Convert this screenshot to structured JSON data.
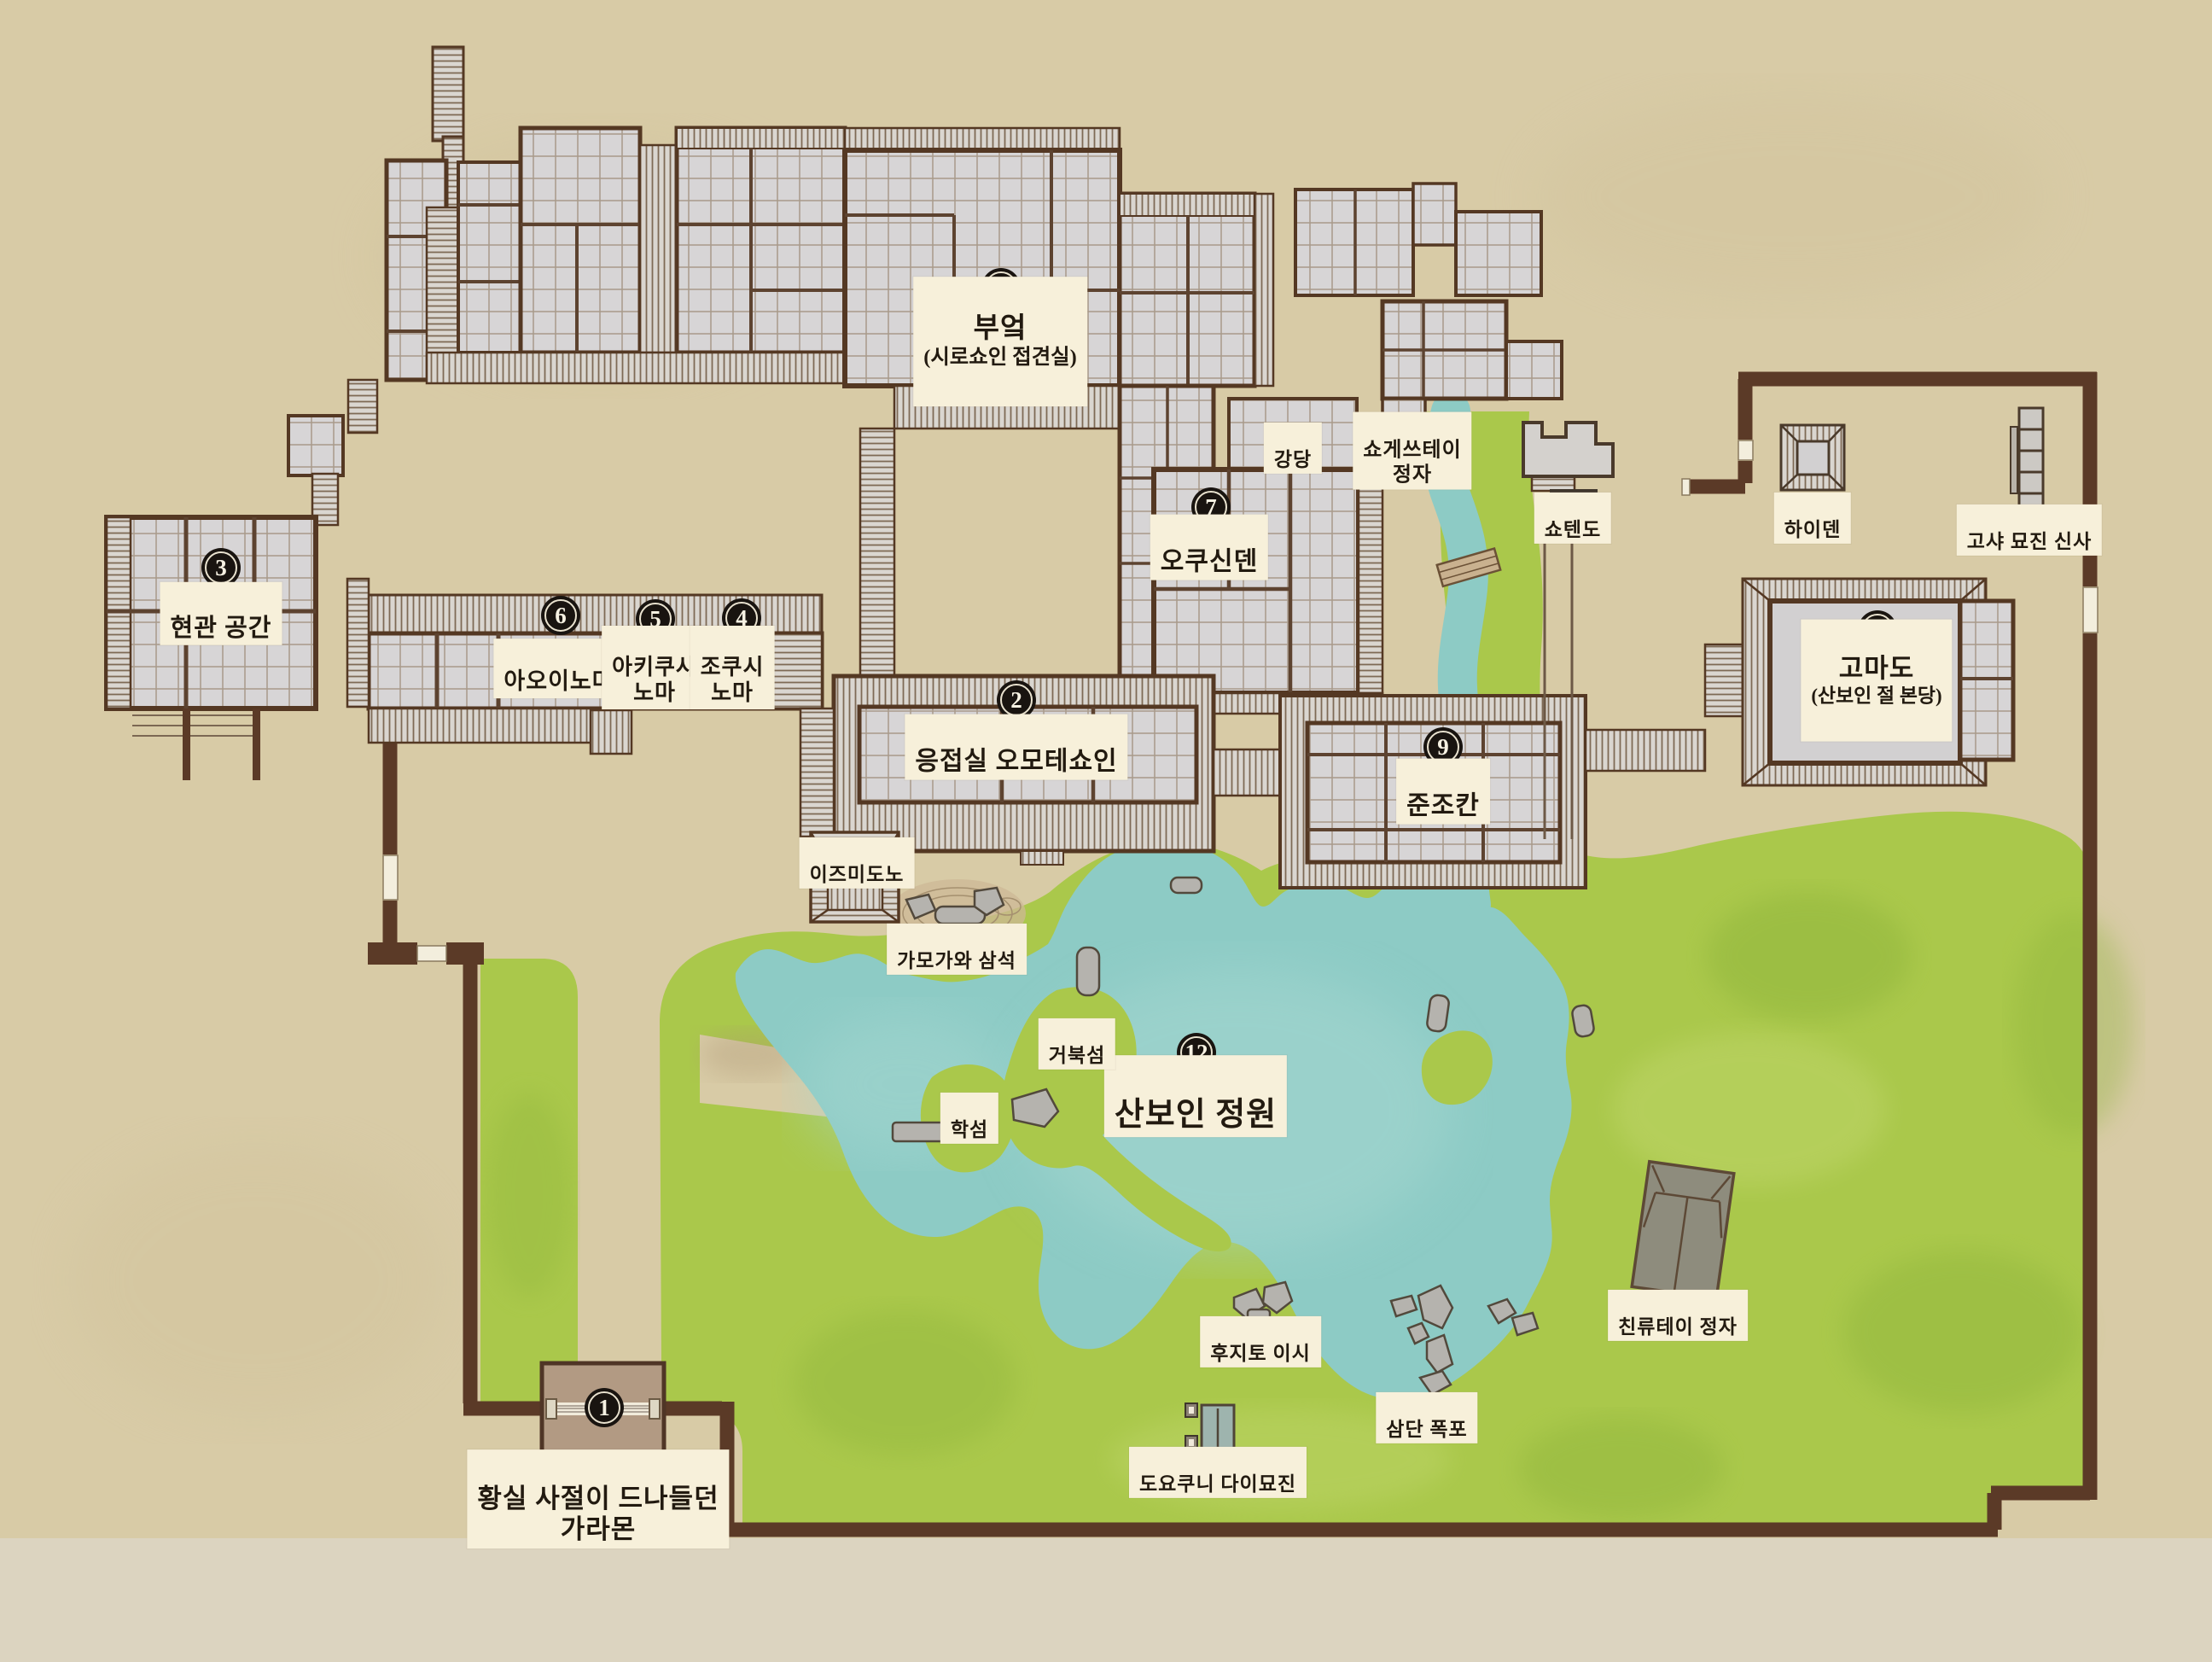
{
  "map": {
    "title_note": "산보인(三宝院) 경내 안내도",
    "colors": {
      "paper": "#d8cba6",
      "paper_outside": "#dcd4c0",
      "wall_brown": "#5b3a27",
      "building_gray": "#d7d5d6",
      "veranda_gray": "#dad6d0",
      "garden_green": "#aac84b",
      "pond_teal": "#8dcbc5",
      "stone_gray": "#b5b3ae",
      "label_cream": "#f7f0da",
      "badge_black": "#191410",
      "karamon_tan": "#b29a83"
    },
    "badges": {
      "b1": {
        "number": "1"
      },
      "b2": {
        "number": "2"
      },
      "b3": {
        "number": "3"
      },
      "b4": {
        "number": "4"
      },
      "b5": {
        "number": "5"
      },
      "b6": {
        "number": "6"
      },
      "b7": {
        "number": "7"
      },
      "b8": {
        "number": "8"
      },
      "b9": {
        "number": "9"
      },
      "b10": {
        "number": "10"
      },
      "b12": {
        "number": "12"
      }
    },
    "labels": {
      "kitchen": {
        "text": "부엌",
        "sub": "(시로쇼인 접견실)"
      },
      "genkan": {
        "text": "현관 공간"
      },
      "aoinoma": {
        "text": "아오이노마"
      },
      "akikusa": {
        "text": "아키쿠사\n노마"
      },
      "chokushi": {
        "text": "조쿠시\n노마"
      },
      "omoteshoin": {
        "text": "응접실 오모테쇼인"
      },
      "izumidono": {
        "text": "이즈미도노"
      },
      "okushinden": {
        "text": "오쿠신덴"
      },
      "kodo": {
        "text": "강당"
      },
      "shogetsutei": {
        "text": "쇼게쓰테이\n정자"
      },
      "shotendo": {
        "text": "쇼텐도"
      },
      "haiden": {
        "text": "하이덴"
      },
      "gosha": {
        "text": "고샤 묘진 신사"
      },
      "komado": {
        "text": "고마도",
        "sub": "(산보인 절 본당)"
      },
      "junjokan": {
        "text": "준조칸"
      },
      "garden": {
        "text": "산보인 정원"
      },
      "kamogawa": {
        "text": "가모가와 삼석"
      },
      "turtle": {
        "text": "거북섬"
      },
      "crane": {
        "text": "학섬"
      },
      "fujito": {
        "text": "후지토 이시"
      },
      "waterfall": {
        "text": "삼단 폭포"
      },
      "toyokuni": {
        "text": "도요쿠니 다이묘진"
      },
      "chinryutei": {
        "text": "친류테이 정자"
      },
      "karamon": {
        "text": "황실 사절이 드나들던\n가라몬"
      }
    }
  }
}
